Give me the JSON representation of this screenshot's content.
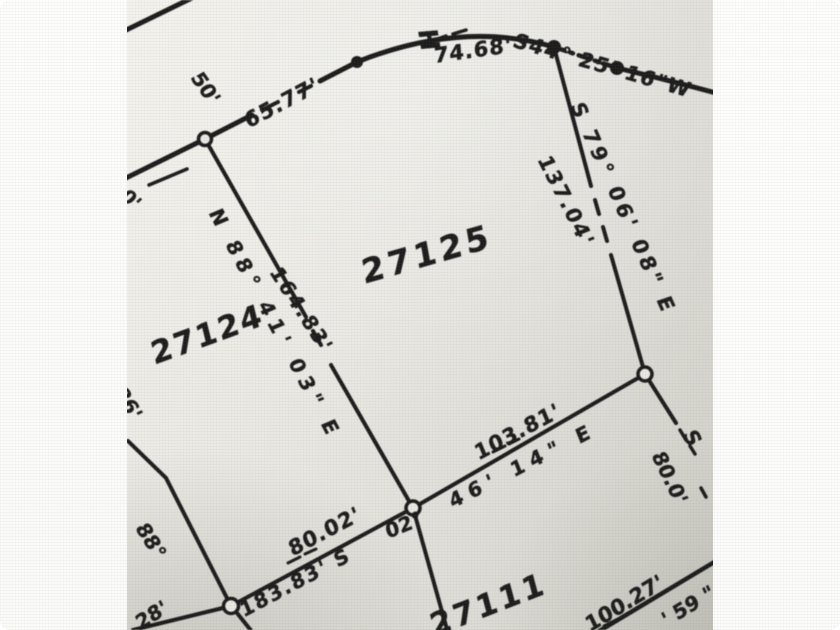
{
  "colors": {
    "ink": "#1c1c1c",
    "paper_light": "#f1f0ea",
    "paper_dark": "#cfcfc8",
    "frame": "#ffffff"
  },
  "labels": {
    "h": "H",
    "dist_7468": "74.68'",
    "brg_s44": "S44° 25' 16\"W",
    "road_width_50": "50'",
    "dist_6577": "65.77'",
    "frag_0": "0'",
    "brg_n88": "N 88° 41' 03\" E",
    "dist_16483": "164.83'",
    "lot_27124": "27124",
    "lot_27125": "27125",
    "brg_s79": "S 79° 06' 08\" E",
    "dist_13704": "137.04'",
    "dist_10381": "103.81'",
    "brg_4614": "46' 14\" E",
    "brg_02": "02°",
    "dist_8002": "80.02'",
    "dist_18383_s": "183.83' S",
    "ang_88": "88°",
    "dist_86": "86'",
    "dist_28": "28'",
    "lot_27111": "27111",
    "dist_10027": "100.27'",
    "frag_59": "' 59 \"",
    "frag_s": "S",
    "dist_800": "80.0'"
  }
}
